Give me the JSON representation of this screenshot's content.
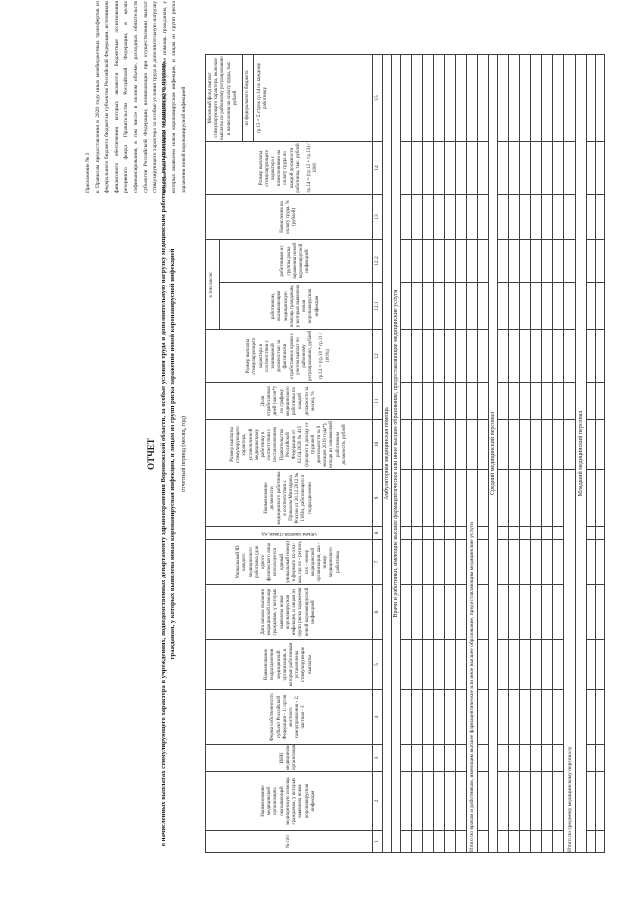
{
  "document": {
    "appendix_label": "Приложение № 3",
    "appendix_text": "к Правилам предоставления в 2020 году иных межбюджетных трансфертов из федерального бюджета бюджетам субъектов Российской Федерации, источником финансового обеспечения которых являются бюджетные ассигнования резервного фонда Правительства Российской Федерации, в целях софинансирования, в том числе в полном объеме, расходных обязательств субъектов Российской Федерации, возникающих при осуществлении выплат стимулирующего характера за особые условия труда и дополнительную нагрузку медицинским работникам, оказывающим медицинскую помощь гражданам, у которых выявлена новая коронавирусная инфекция, и лицам из групп риска заражения новой коронавирусной инфекцией",
    "title": "ОТЧЕТ",
    "subtitle": "о начисленных выплатах стимулирующего характера в учреждениях, подведомственных департаменту здравоохранения Воронежской области, за особые условия труда и дополнительную нагрузку медицинским работникам, оказывающим медицинскую помощь гражданам, у которых выявлена новая коронавирусная инфекция, и лицам из групп риска заражения новой коронавирусной инфекцией",
    "period_note": "отчетный период (месяц, год)"
  },
  "table": {
    "group_header": "в том числе:",
    "columns": [
      {
        "num": "1",
        "title": "№ п/п"
      },
      {
        "num": "2",
        "title": "Наименование медицинской организации, оказывающей медицинскую помощь гражданам, у которых выявлена новая коронавирусная инфекция"
      },
      {
        "num": "3",
        "title": "ИНН медицинской организации"
      },
      {
        "num": "4",
        "title": "Форма собственности: субъект Российской Федерации - 1; орган местного самоуправления - 2; частная - 3"
      },
      {
        "num": "5",
        "title": "Наименование подразделения медицинской организации, в которых работникам установлены стимулирующие выплаты"
      },
      {
        "num": "6",
        "title": "Дата начала оказания медицинской помощи гражданам, у которых выявлена новая коронавирусная инфекция, и лицам из групп риска заражения новой коронавирусной инфекцией"
      },
      {
        "num": "7",
        "title": "Уникальный ID каждого медицинского работника (для одного физического лица используется единый уникальный номер) в формате хх-ххх-ааа, где хх - регион, ххх - номер медицинской организации, ааа - номер медицинского работника"
      },
      {
        "num": "8",
        "title": "Объем занятой ставки, ед."
      },
      {
        "num": "9",
        "title": "Наименование должности медицинского работника в соответствии с Приказом Минздрава России от 20.12.2012 № 1183н, работающего в подразделении"
      },
      {
        "num": "10",
        "title": "Размер выплаты стимулирующего характера, установленной медицинскому работнику в соответствии с постановлением Правительства Российской Федерации от 02.04.2020 № 415 (процент к доходу от трудовой деятельности за 9 месяцев 2019 года*), исходя из занимаемой работником должности, рублей"
      },
      {
        "num": "11",
        "title": "Доля отработанных дней (часов*) по графику медицинского работника по каждой должности за месяц, %"
      },
      {
        "num": "12",
        "title": "Размер выплаты стимулирующего характера в соответствии с занимаемой должностью за фактически отработанное время с учетом выплат по районному регулированию, рублей",
        "formula": "гр.12 = (гр.10 * гр.11 / 100%)"
      },
      {
        "num": "12.1",
        "title": "работникам, оказывающим медицинскую помощь гражданам, у которых выявлена новая коронавирусная инфекция"
      },
      {
        "num": "12.2",
        "title": "работникам из группы риска заражения новой коронавирусной инфекцией"
      },
      {
        "num": "13",
        "title": "Начисления на оплату труда, % (рублей)"
      },
      {
        "num": "14",
        "title": "Размер выплаты стимулирующего характера с начислениями на оплату труда по каждой должности работника, тыс. рублей",
        "formula": "гр.14 = (гр.12 + гр.13) / 1000"
      },
      {
        "num": "15",
        "title": "Месячный фонд выплат стимулирующего характера, включая выплаты по районному регулированию и начисления на оплату труда, тыс. рублей",
        "source": "из федерального бюджета",
        "formula": "гр.15 = Σ строк гр.14 по каждому работнику"
      }
    ],
    "sections": {
      "ambulatory": "Амбулаторная медицинская помощь",
      "doctors": "Врачи и работники, имеющие высшее фармацевтическое или иное высшее образование, предоставляющие медицинские услуги",
      "doctors_total": "Итого по врачам и работникам, имеющим высшее фармацевтическое или иное высшее образование, предоставляющим медицинские услуги",
      "middle": "Средний медицинский персонал",
      "middle_total": "Итого по среднему медицинскому персоналу",
      "junior": "Младший медицинский персонал"
    }
  }
}
